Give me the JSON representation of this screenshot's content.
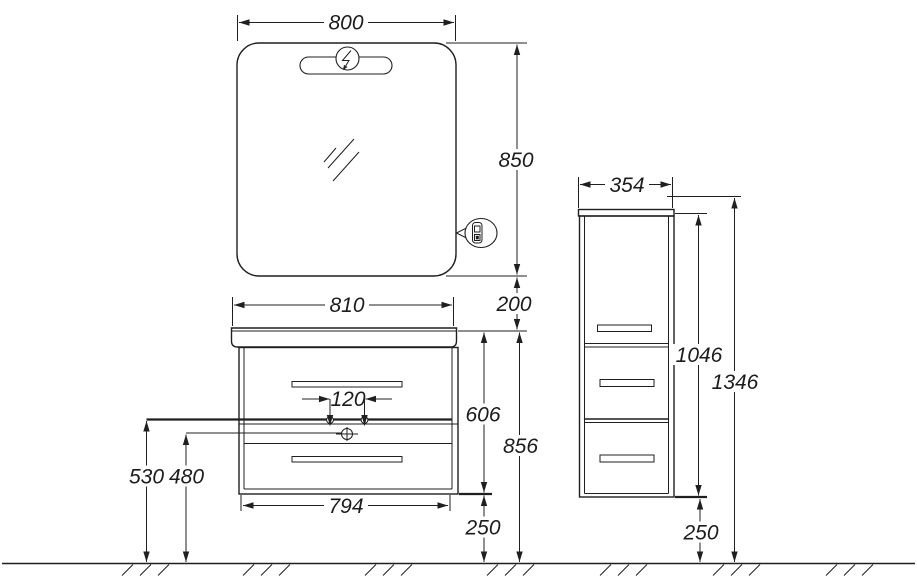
{
  "meta": {
    "title": "Bathroom furniture installation drawing",
    "background": "#ffffff",
    "ink_color": "#1f1f1f",
    "units": "mm"
  },
  "symbols": {
    "light": "lightning-bolt-icon",
    "power": "socket-outlet-icon",
    "drain": "crossed-circle-icon",
    "water_supply": "small-circle-icon",
    "floor": "hatched-ground-line"
  },
  "mirror": {
    "width_label": "800",
    "height_label": "850",
    "gap_below_label": "200"
  },
  "vanity": {
    "basin_width_label": "810",
    "faucet_spacing_label": "120",
    "body_height_label": "606",
    "basin_height_label": "856",
    "floor_gap_label": "250",
    "body_width_label": "794",
    "supply_height_label": "530",
    "drain_height_label": "480"
  },
  "column": {
    "width_label": "354",
    "body_height_label": "1046",
    "total_height_label": "1346",
    "floor_gap_label": "250"
  }
}
